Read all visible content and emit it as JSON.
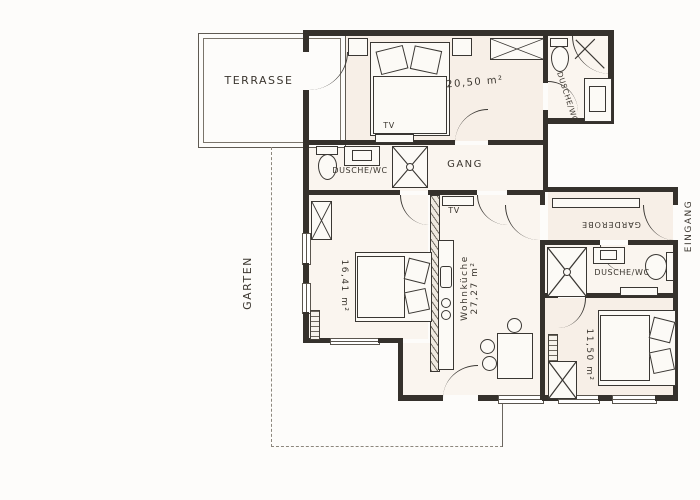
{
  "plan": {
    "outdoor": {
      "terrasse": "TERRASSE",
      "garten": "GARTEN",
      "eingang": "EINGANG"
    },
    "rooms": {
      "bedroom_top": {
        "area": "20,50 m²"
      },
      "gang": {
        "name": "GANG"
      },
      "bath_top": {
        "name": "DUSCHE/WC"
      },
      "bath_mid": {
        "name": "DUSCHE/WC"
      },
      "bath_right": {
        "name": "DUSCHE/WC"
      },
      "bedroom_left": {
        "area": "16,41 m²"
      },
      "wohnkueche": {
        "name": "Wohnküche",
        "area": "27,27 m²"
      },
      "garderobe": {
        "name": "GARDEROBE"
      },
      "bedroom_right": {
        "area": "11,50 m²"
      }
    },
    "annotations": {
      "tv_bedroom_top": "TV",
      "tv_wohnkueche": "TV"
    },
    "colors": {
      "paper": "#fdfcfa",
      "wall": "#35312c",
      "room_tint": "#f7efe7"
    }
  }
}
